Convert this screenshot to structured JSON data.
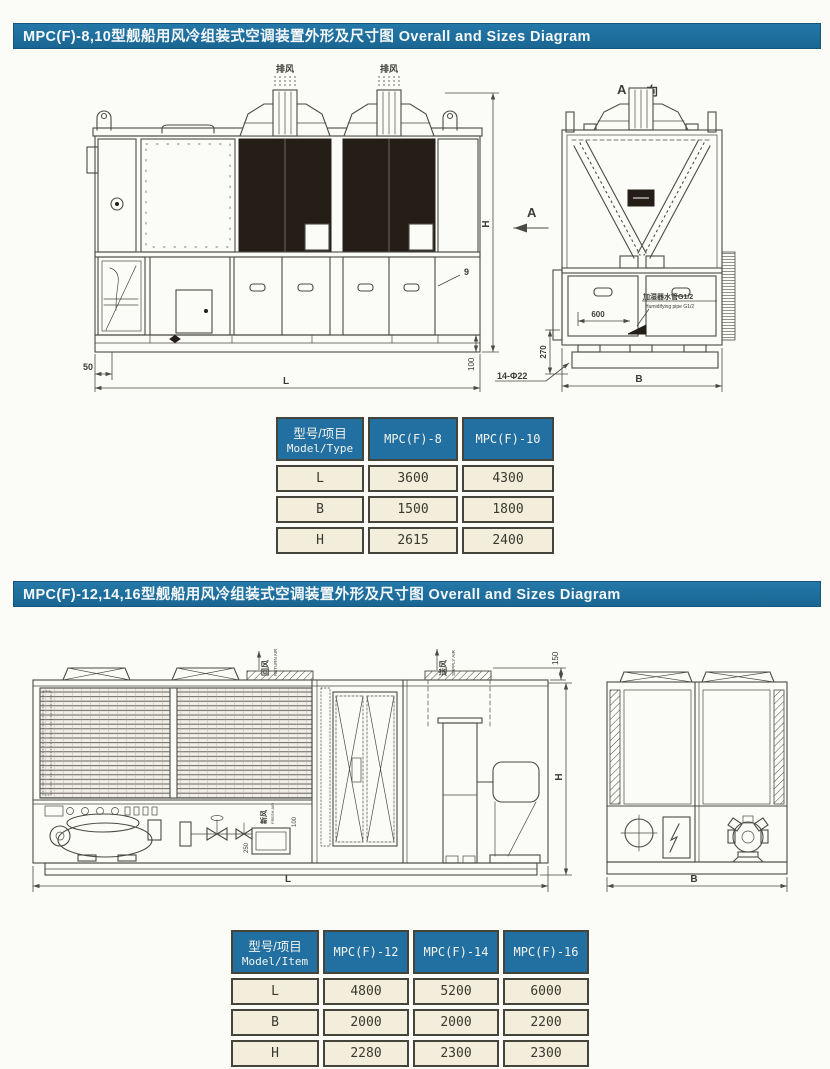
{
  "colors": {
    "banner_bg": "#1e6f9f",
    "table_header_bg": "#2270a2",
    "table_cell_bg": "#f3eedb",
    "line": "#4b4b44",
    "panel_dark": "#241e17"
  },
  "section1": {
    "banner": "MPC(F)-8,10型舰船用风冷组装式空调装置外形及尺寸图  Overall and Sizes Diagram",
    "drawing": {
      "exhaust_label": "排风",
      "view_title_a": "A",
      "view_title_dir": "向",
      "view_arrow": "A",
      "dim_h": "H",
      "dim_l": "L",
      "dim_50": "50",
      "dim_100": "100",
      "dim_600": "600",
      "dim_270": "270",
      "dim_b": "B",
      "callout_9": "9",
      "holes_note": "14-Φ22",
      "pipe_note_cn": "加湿器水管G1/2",
      "pipe_note_en": "Humidifying pipe G1/2"
    },
    "table": {
      "corner_cn": "型号/项目",
      "corner_en": "Model/Type",
      "columns": [
        "MPC(F)-8",
        "MPC(F)-10"
      ],
      "rows": [
        {
          "label": "L",
          "values": [
            "3600",
            "4300"
          ]
        },
        {
          "label": "B",
          "values": [
            "1500",
            "1800"
          ]
        },
        {
          "label": "H",
          "values": [
            "2615",
            "2400"
          ]
        }
      ]
    }
  },
  "section2": {
    "banner": "MPC(F)-12,14,16型舰船用风冷组装式空调装置外形及尺寸图  Overall and Sizes Diagram",
    "drawing": {
      "return_cn": "回风",
      "return_en": "RETURN AIR",
      "supply_cn": "送风",
      "supply_en": "SUPPLY AIR",
      "fresh_cn": "新风",
      "fresh_en": "FRESH AIR",
      "dim_150": "150",
      "dim_250": "250",
      "dim_100": "100",
      "dim_h": "H",
      "dim_l": "L",
      "dim_b": "B"
    },
    "table": {
      "corner_cn": "型号/项目",
      "corner_en": "Model/Item",
      "columns": [
        "MPC(F)-12",
        "MPC(F)-14",
        "MPC(F)-16"
      ],
      "rows": [
        {
          "label": "L",
          "values": [
            "4800",
            "5200",
            "6000"
          ]
        },
        {
          "label": "B",
          "values": [
            "2000",
            "2000",
            "2200"
          ]
        },
        {
          "label": "H",
          "values": [
            "2280",
            "2300",
            "2300"
          ]
        }
      ]
    }
  }
}
